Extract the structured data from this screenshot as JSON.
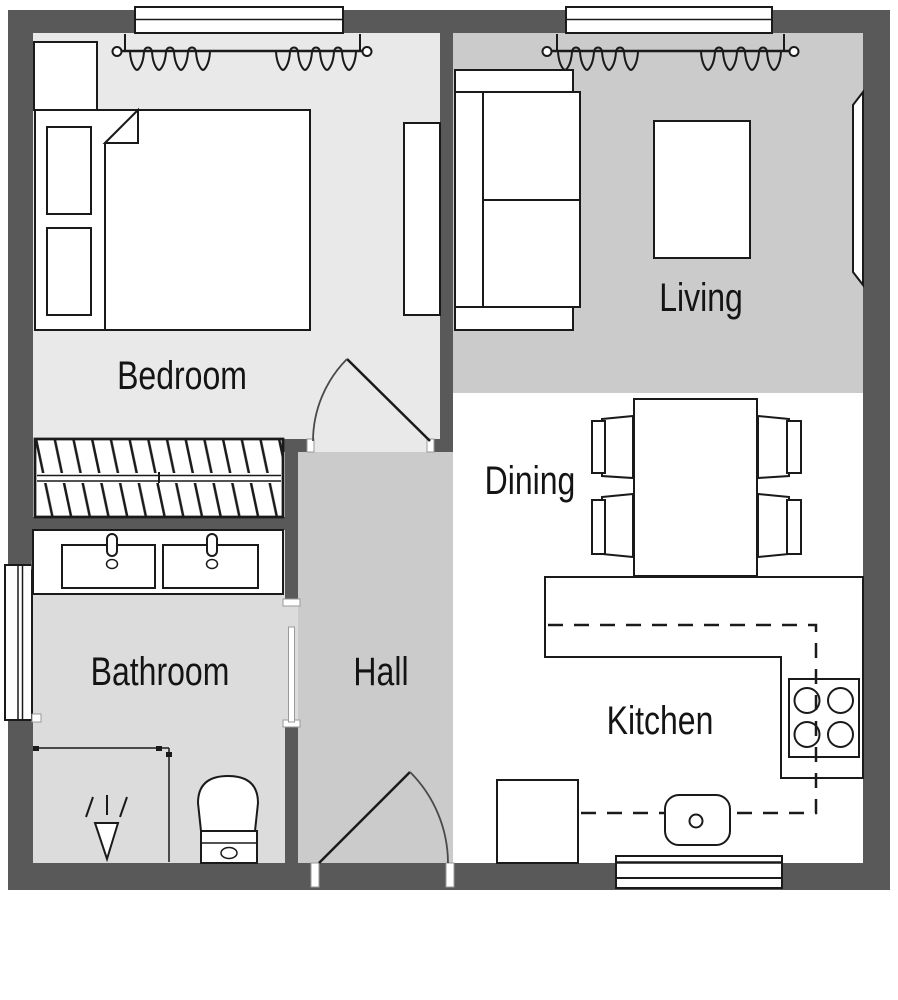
{
  "rooms": [
    {
      "id": "bedroom",
      "label": "Bedroom",
      "furniture": [
        "double-bed",
        "pillow",
        "pillow",
        "duvet",
        "dresser",
        "wardrobe",
        "radiator",
        "window",
        "curtains",
        "door"
      ]
    },
    {
      "id": "living",
      "label": "Living",
      "furniture": [
        "sofa",
        "coffee-table",
        "wall-tv",
        "window",
        "curtains"
      ]
    },
    {
      "id": "dining",
      "label": "Dining",
      "furniture": [
        "dining-table",
        "chair",
        "chair",
        "chair",
        "chair"
      ]
    },
    {
      "id": "hall",
      "label": "Hall",
      "furniture": [
        "entrance-door"
      ]
    },
    {
      "id": "bathroom",
      "label": "Bathroom",
      "furniture": [
        "vanity-double-sink",
        "toilet",
        "shower",
        "window",
        "door"
      ]
    },
    {
      "id": "kitchen",
      "label": "Kitchen",
      "furniture": [
        "l-shaped-counter",
        "hob",
        "sink",
        "base-cabinet",
        "overhead-cabinet-line",
        "window"
      ]
    }
  ],
  "colors": {
    "wall": "#595959",
    "bedroom_floor": "#e9e9e9",
    "living_floor": "#cbcbcb",
    "hall_floor": "#cbcbcb",
    "bathroom_floor": "#dcdcdc",
    "kitchen_floor": "#ffffff",
    "furniture_fill": "#ffffff",
    "line": "#1a1a1a",
    "background": "#ffffff"
  }
}
